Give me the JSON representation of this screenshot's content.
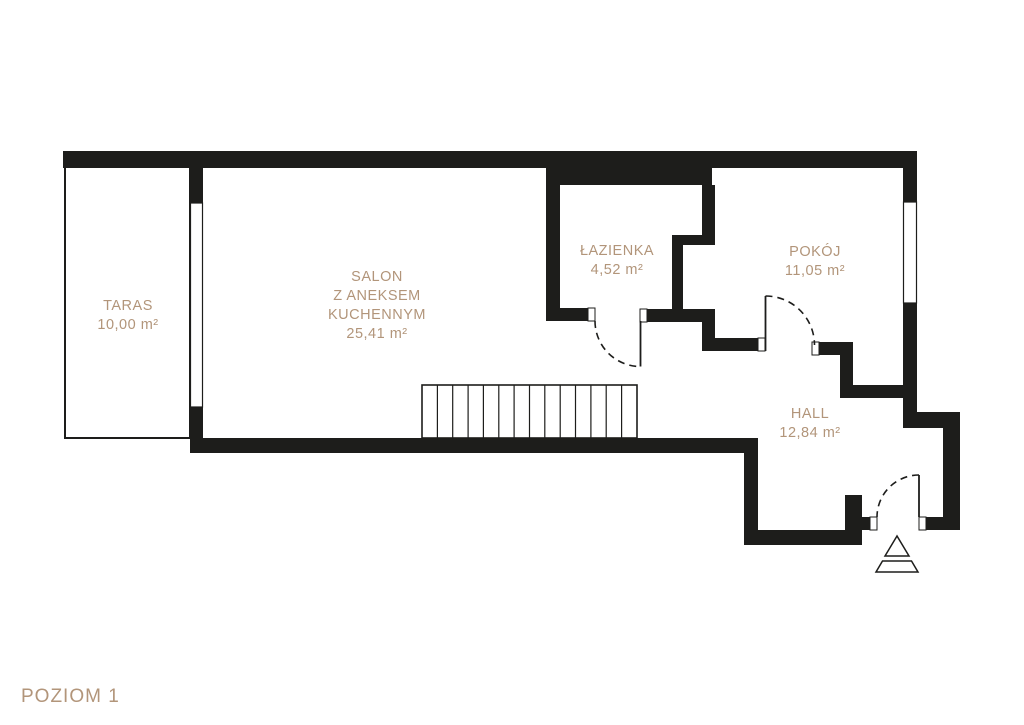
{
  "plan": {
    "title": "POZIOM 1",
    "colors": {
      "wall": "#1d1d1b",
      "label": "#b2957a",
      "background": "#ffffff"
    },
    "rooms": {
      "taras": {
        "label": "TARAS",
        "area": "10,00 m²"
      },
      "salon": {
        "line1": "SALON",
        "line2": "Z ANEKSEM",
        "line3": "KUCHENNYM",
        "area": "25,41 m²"
      },
      "lazienka": {
        "label": "ŁAZIENKA",
        "area": "4,52 m²"
      },
      "pokoj": {
        "label": "POKÓJ",
        "area": "11,05 m²"
      },
      "hall": {
        "label": "HALL",
        "area": "12,84 m²"
      }
    },
    "features": {
      "staircase_treads": 14,
      "doors": [
        "lazienka-door",
        "pokoj-door",
        "entrance-door"
      ],
      "windows": [
        "taras-salon-window",
        "pokoj-window"
      ],
      "entrance_marker": "triangle-arrow"
    }
  }
}
